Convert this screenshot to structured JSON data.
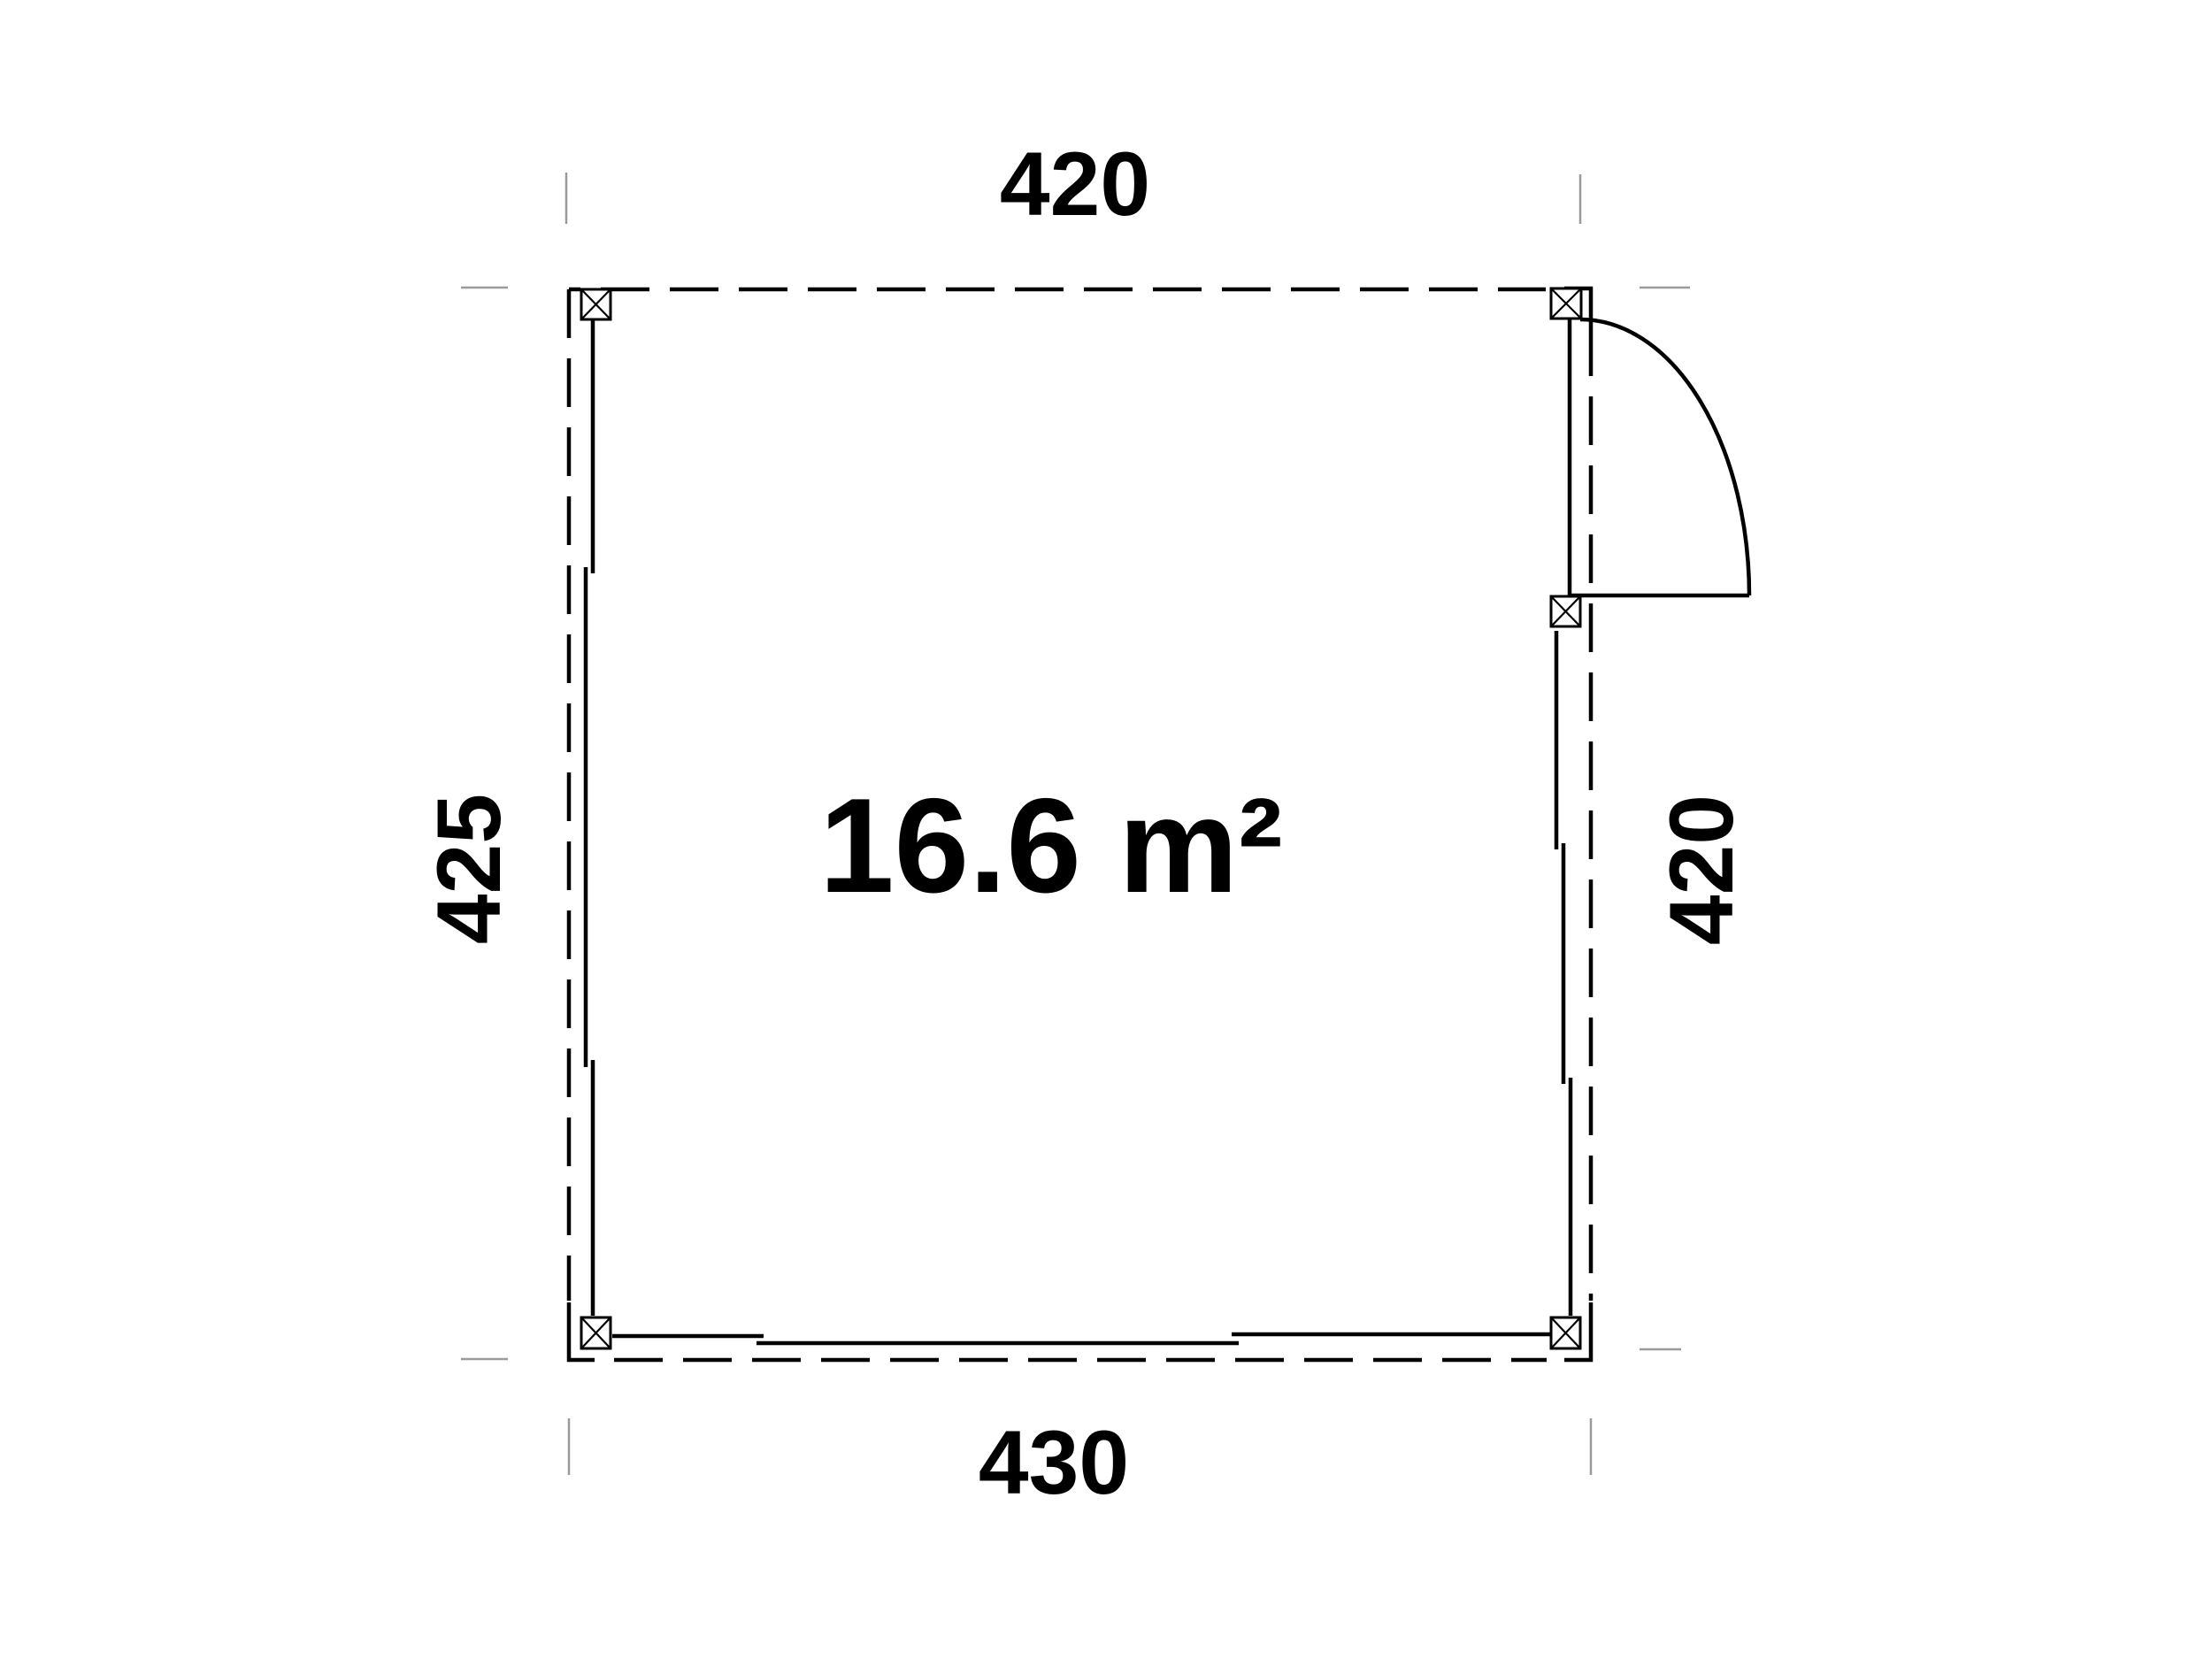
{
  "floor_plan": {
    "area_label": "16.6 m²",
    "dimensions": {
      "top": "420",
      "bottom": "430",
      "left": "425",
      "right": "420"
    },
    "colors": {
      "line": "#000000",
      "extension_tick": "#9a9a9a",
      "background": "#ffffff"
    }
  }
}
